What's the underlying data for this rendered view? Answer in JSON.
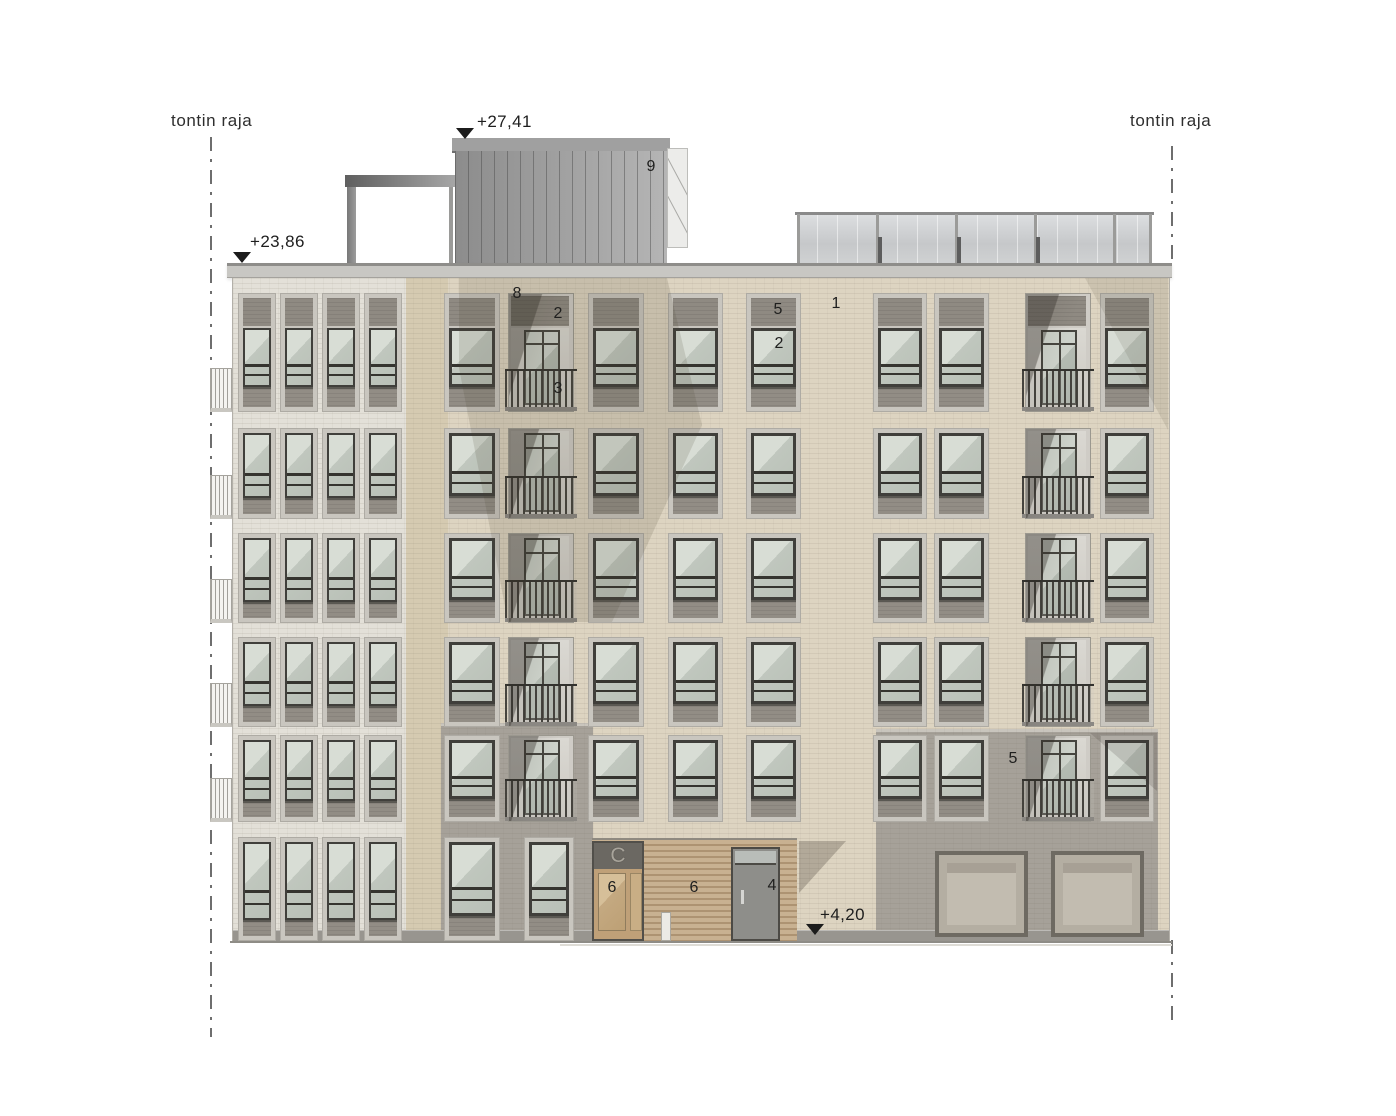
{
  "drawing": {
    "background": "#ffffff",
    "boundary_label_left": "tontin raja",
    "boundary_label_right": "tontin raja",
    "boundary_label_left_pos": {
      "x": 171,
      "y": 111
    },
    "boundary_label_right_pos": {
      "x": 1130,
      "y": 111
    },
    "boundary_lines": [
      {
        "x": 210,
        "segments": [
          [
            137,
            1037
          ]
        ]
      },
      {
        "x": 1171,
        "segments": [
          [
            146,
            262
          ],
          [
            940,
            1028
          ]
        ]
      }
    ],
    "elevation_markers": [
      {
        "text": "+27,41",
        "text_x": 477,
        "text_y": 112,
        "tri_x": 456,
        "tri_y": 128
      },
      {
        "text": "+23,86",
        "text_x": 250,
        "text_y": 232,
        "tri_x": 233,
        "tri_y": 252
      },
      {
        "text": "+4,20",
        "text_x": 820,
        "text_y": 905,
        "tri_x": 806,
        "tri_y": 924
      }
    ],
    "annotations": [
      {
        "text": "9",
        "x": 651,
        "y": 167
      },
      {
        "text": "8",
        "x": 517,
        "y": 294
      },
      {
        "text": "2",
        "x": 558,
        "y": 314
      },
      {
        "text": "3",
        "x": 558,
        "y": 389
      },
      {
        "text": "5",
        "x": 778,
        "y": 310
      },
      {
        "text": "2",
        "x": 779,
        "y": 344
      },
      {
        "text": "1",
        "x": 836,
        "y": 304
      },
      {
        "text": "5",
        "x": 1013,
        "y": 759
      },
      {
        "text": "6",
        "x": 612,
        "y": 888
      },
      {
        "text": "6",
        "x": 694,
        "y": 888
      },
      {
        "text": "4",
        "x": 772,
        "y": 886
      }
    ],
    "entrance_sign": "C",
    "colors": {
      "left_wing_brick": "#e3e0d8",
      "tan_pier_brick": "#d5cab1",
      "main_brick": "#ddd4c1",
      "gray_brick": "#a6a199",
      "window_frame": "#403f3b",
      "glass_light": "#d8ddd5",
      "glass_dark": "#b9c0b7",
      "spandrel": "#928d85",
      "penthouse_metal": "#9e9e9e",
      "wood_cladding": "#c8b191",
      "door_wood": "#bfa078",
      "marker_black": "#1c1c1c"
    },
    "roof": {
      "penthouse": {
        "x": 455,
        "w": 212,
        "y": 140,
        "h": 123
      },
      "coping": {
        "x": 452,
        "w": 218,
        "y": 138,
        "h": 13
      },
      "appendage": {
        "x": 667,
        "w": 19,
        "y": 148,
        "h": 98
      },
      "pergola_beam": {
        "x": 345,
        "w": 113,
        "y": 175,
        "h": 12
      },
      "pergola_post": {
        "x": 347,
        "w": 9,
        "y": 187,
        "h": 76
      },
      "pergola_post2": {
        "x": 449,
        "w": 4,
        "y": 187,
        "h": 76
      },
      "railing": {
        "x": 797,
        "w": 355,
        "y": 212,
        "h": 51,
        "posts": [
          0,
          79,
          158,
          237,
          316,
          352
        ],
        "stubs": [
          81,
          160,
          239
        ]
      }
    },
    "parapet": {
      "x": 227,
      "w": 945,
      "y": 263,
      "h": 15
    },
    "facade": {
      "x": 232,
      "y": 278,
      "w": 936,
      "h": 665,
      "left_wing_w": 175,
      "tan_pier": {
        "x": 405,
        "w": 42
      },
      "gray_zone_a": {
        "x": 440,
        "w": 152,
        "y": 723,
        "h": 220
      },
      "gray_zone_b": {
        "x": 875,
        "w": 282,
        "y": 729,
        "h": 214
      },
      "plinth": {
        "y": 930,
        "h": 13
      },
      "rows": [
        {
          "top": 293,
          "h": 119,
          "tall": true
        },
        {
          "top": 428,
          "h": 91,
          "tall": false
        },
        {
          "top": 533,
          "h": 90,
          "tall": false
        },
        {
          "top": 637,
          "h": 90,
          "tall": false
        },
        {
          "top": 735,
          "h": 87,
          "tall": false
        }
      ],
      "ground_row": {
        "top": 837,
        "h": 104
      },
      "left_wing_cols": [
        238,
        280,
        322,
        364
      ],
      "left_wing_col_w": 38,
      "main_cols": [
        {
          "x": 444,
          "w": 56,
          "kind": "win"
        },
        {
          "x": 508,
          "w": 66,
          "kind": "balc"
        },
        {
          "x": 588,
          "w": 56,
          "kind": "win"
        },
        {
          "x": 668,
          "w": 55,
          "kind": "win"
        },
        {
          "x": 746,
          "w": 55,
          "kind": "win"
        },
        {
          "x": 873,
          "w": 54,
          "kind": "win",
          "rows": [
            1,
            2,
            3,
            4,
            5
          ]
        },
        {
          "x": 934,
          "w": 55,
          "kind": "win",
          "rows": [
            1,
            2,
            3,
            4,
            5
          ]
        },
        {
          "x": 1025,
          "w": 66,
          "kind": "balc",
          "rows": [
            1,
            2,
            3,
            4,
            5
          ]
        },
        {
          "x": 1100,
          "w": 54,
          "kind": "win",
          "rows": [
            1,
            2,
            3,
            4,
            5
          ]
        }
      ],
      "ground_windows": [
        {
          "x": 444,
          "w": 56
        },
        {
          "x": 524,
          "w": 50
        }
      ],
      "side_balconies": [
        {
          "x": 210,
          "y": 368,
          "w": 22,
          "h": 44
        },
        {
          "x": 210,
          "y": 475,
          "w": 22,
          "h": 44
        },
        {
          "x": 210,
          "y": 579,
          "w": 22,
          "h": 44
        },
        {
          "x": 210,
          "y": 683,
          "w": 22,
          "h": 44
        },
        {
          "x": 210,
          "y": 778,
          "w": 22,
          "h": 44
        }
      ]
    },
    "ground": {
      "wood_wall": {
        "x": 592,
        "w": 205,
        "y": 838,
        "h": 103
      },
      "door_c": {
        "x": 592,
        "w": 52,
        "y": 841,
        "h": 100
      },
      "door_4": {
        "x": 731,
        "w": 49,
        "y": 847,
        "h": 94
      },
      "bollard": {
        "x": 661,
        "w": 10,
        "y": 912,
        "h": 29
      },
      "garage_doors": [
        {
          "x": 935,
          "w": 93,
          "y": 851,
          "h": 86
        },
        {
          "x": 1051,
          "w": 93,
          "y": 851,
          "h": 86
        }
      ],
      "ground_line": {
        "x": 230,
        "w": 942,
        "y": 941,
        "h": 2
      }
    }
  }
}
